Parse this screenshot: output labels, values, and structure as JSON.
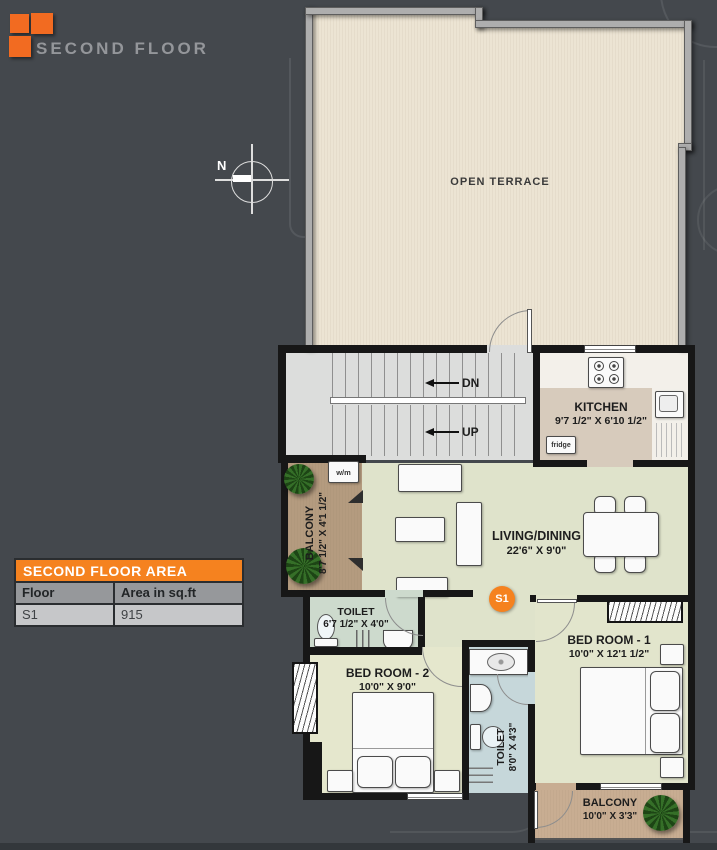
{
  "header": {
    "title": "SECOND FLOOR"
  },
  "compass": {
    "north_label": "N"
  },
  "plan": {
    "terrace": {
      "label": "OPEN TERRACE"
    },
    "stairs": {
      "down_label": "DN",
      "up_label": "UP"
    },
    "kitchen": {
      "name": "KITCHEN",
      "dims": "9'7 1/2\" X 6'10 1/2\"",
      "fridge_label": "fridge"
    },
    "balcony_left": {
      "name": "BALCONY",
      "dims": "8'7 1/2\" X 4'1 1/2\"",
      "washer_label": "w/m"
    },
    "living_dining": {
      "name": "LIVING/DINING",
      "dims": "22'6\" X 9'0\""
    },
    "unit_badge": {
      "label": "S1"
    },
    "toilet_top": {
      "name": "TOILET",
      "dims": "6'7 1/2\" X 4'0\""
    },
    "bedroom2": {
      "name": "BED ROOM - 2",
      "dims": "10'0\" X 9'0\""
    },
    "bedroom1": {
      "name": "BED ROOM - 1",
      "dims": "10'0\" X 12'1 1/2\""
    },
    "toilet_bottom": {
      "name": "TOILET",
      "dims": "8'0\" X 4'3\""
    },
    "balcony_bottom": {
      "name": "BALCONY",
      "dims": "10'0\" X 3'3\""
    }
  },
  "area_table": {
    "title": "SECOND FLOOR AREA",
    "col_floor": "Floor",
    "col_area": "Area in sq.ft",
    "row_floor": "S1",
    "row_area": "915"
  },
  "colors": {
    "accent_orange": "#f5821f",
    "background": "#44484d",
    "terrace_floor": "#ece4d3",
    "wall_black": "#171717",
    "wall_grey": "#aeaeae",
    "living_floor": "#dfe3cb",
    "balcony_floor": "#b49b7f",
    "toilet_floor": "#c6d7da"
  }
}
